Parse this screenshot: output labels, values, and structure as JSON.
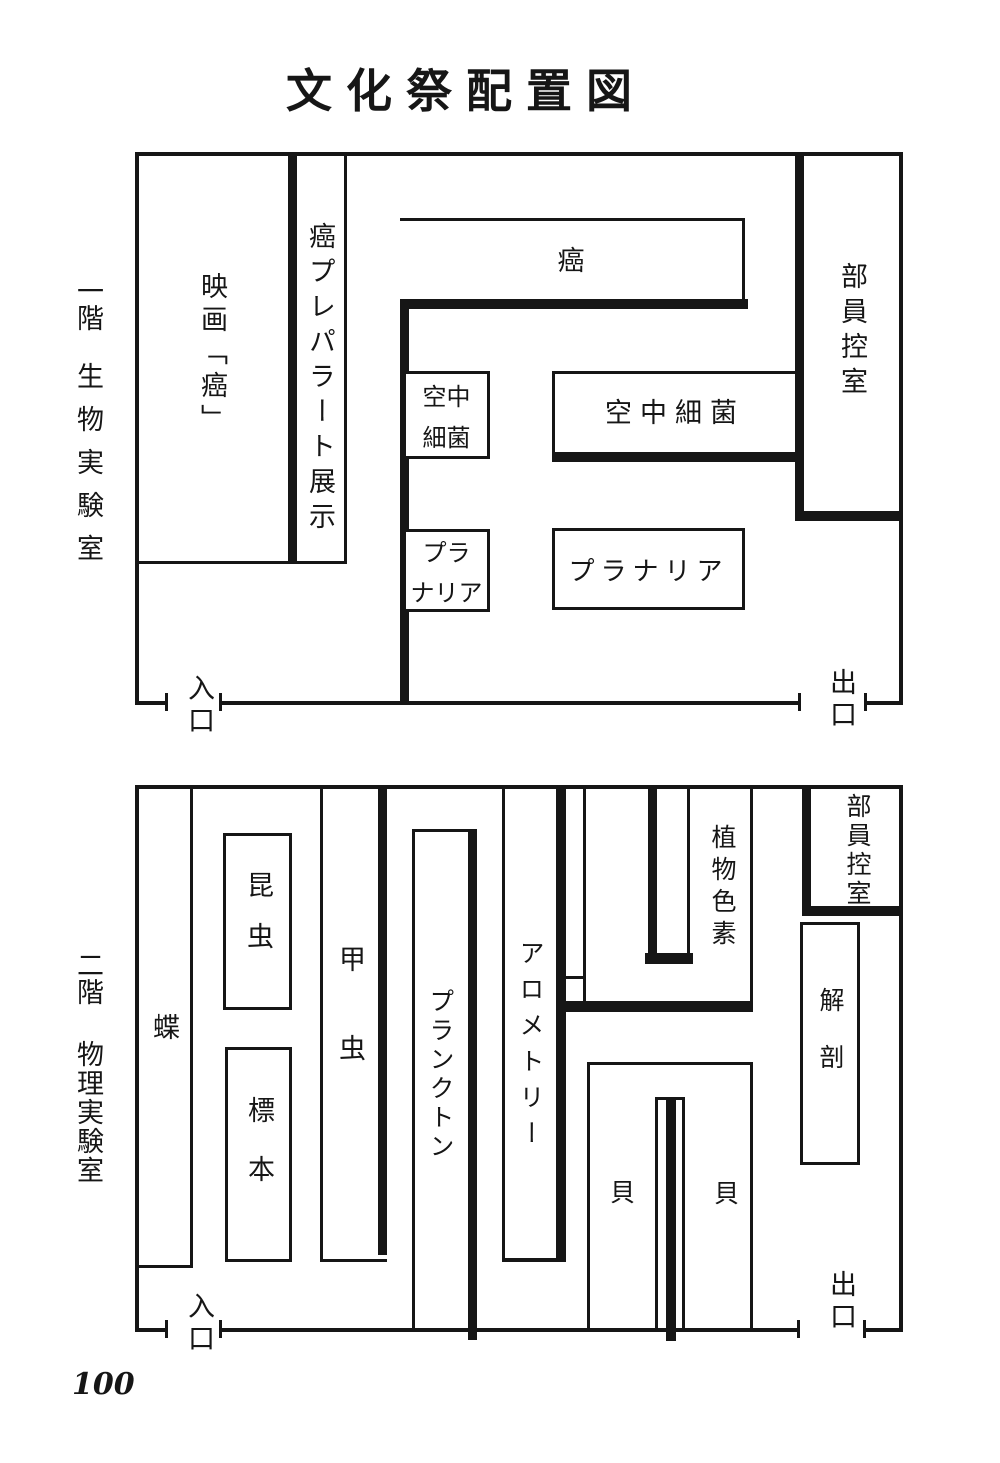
{
  "title": "文化祭配置図",
  "page_number": "100",
  "colors": {
    "ink": "#161616",
    "paper": "#ffffff"
  },
  "floor1": {
    "label_floor": "一階",
    "label_room": "生物実験室",
    "entrance": "入口",
    "exit": "出口",
    "rooms": {
      "movie": "映画「癌」",
      "prep_exhibit": "癌プレパラート展示",
      "cancer": "癌",
      "airborne_small_line1": "空中",
      "airborne_small_line2": "細菌",
      "airborne_large": "空中細菌",
      "planaria_small_line1": "プラ",
      "planaria_small_line2": "ナリア",
      "planaria_large": "プラナリア",
      "staff_room": "部員控室"
    }
  },
  "floor2": {
    "label_floor": "二階",
    "label_room": "物理実験室",
    "entrance": "入口",
    "exit": "出口",
    "rooms": {
      "butterfly": "蝶",
      "insect": "昆虫",
      "specimen": "標本",
      "beetle": "甲虫",
      "plankton": "プランクトン",
      "allometry": "アロメトリー",
      "plant_pigment": "植物色素",
      "staff_room": "部員控室",
      "dissection": "解剖",
      "shell_left": "貝",
      "shell_right": "貝"
    }
  }
}
